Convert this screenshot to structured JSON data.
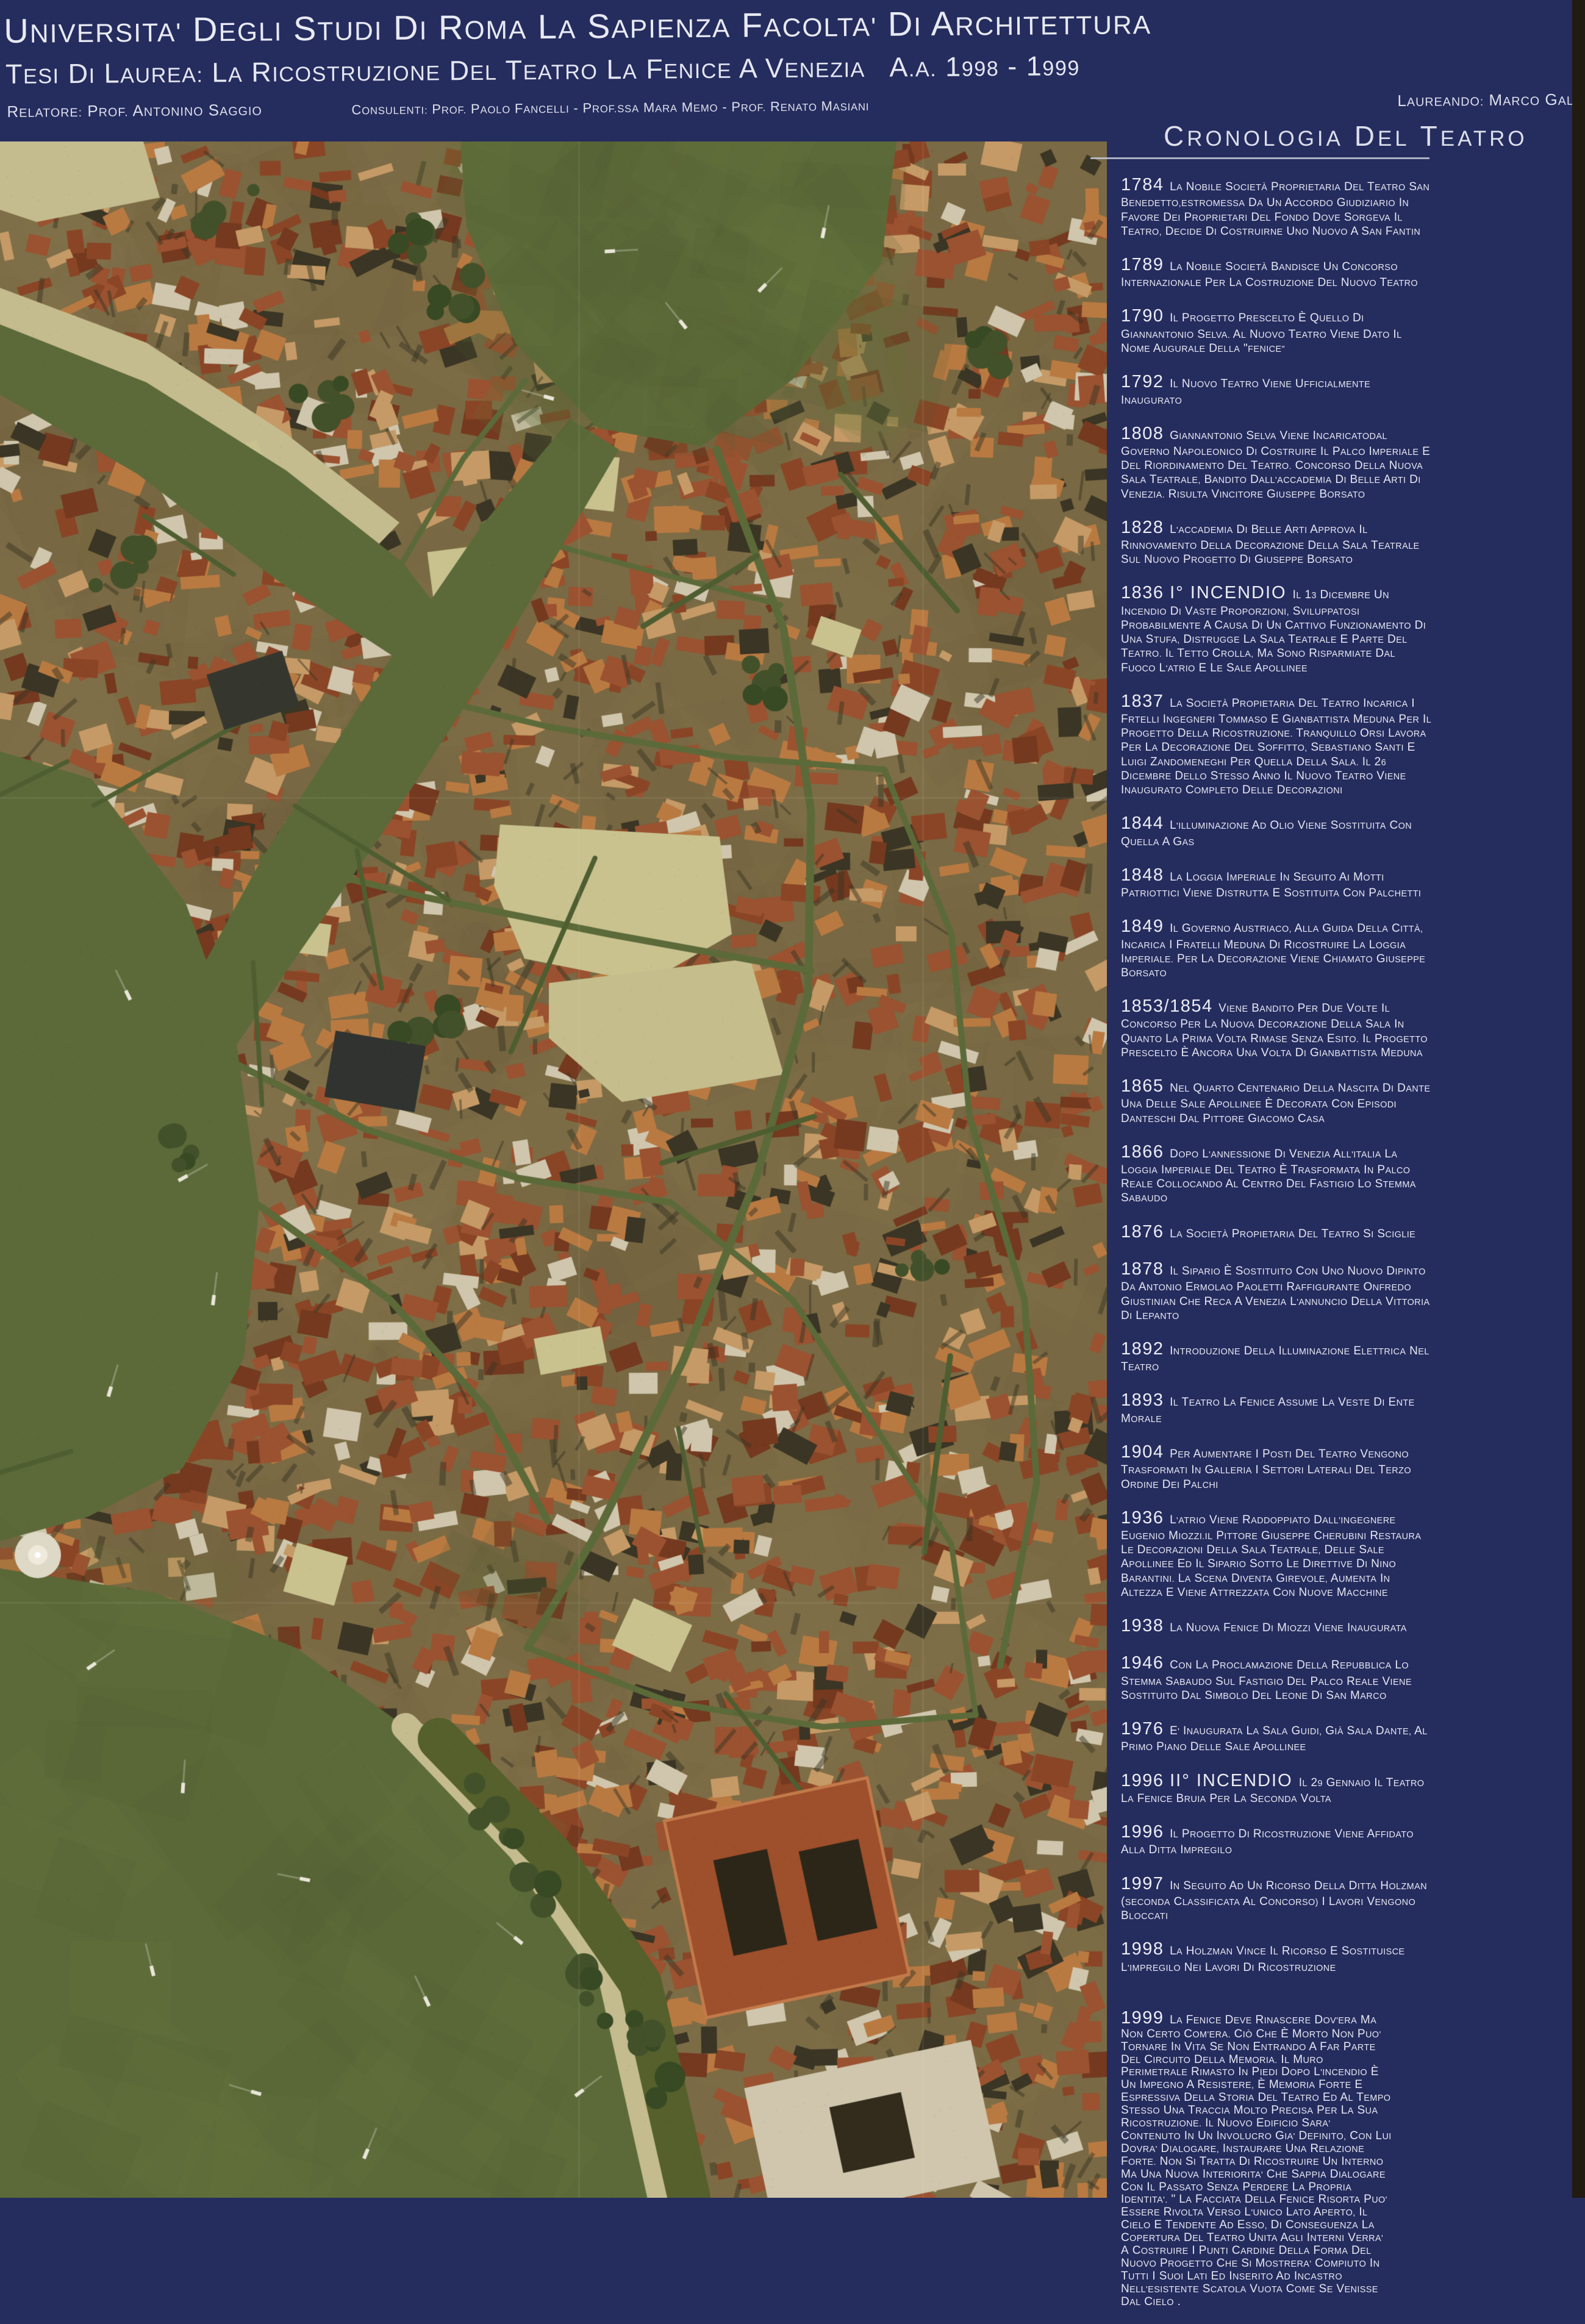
{
  "header": {
    "line1": "UNIVERSITA' DEGLI STUDI DI ROMA LA SAPIENZA FACOLTA' DI ARCHITETTURA",
    "line2": "TESI DI LAUREA: LA RICOSTRUZIONE DEL TEATRO LA FENICE A VENEZIA   A.A. 1998 - 1999",
    "relatore": "RELATORE: PROF. ANTONINO SAGGIO",
    "consulenti": "CONSULENTI: PROF. PAOLO FANCELLI - PROF.SSA MARA MEMO - PROF. RENATO MASIANI",
    "laureando": "LAUREANDO: MARCO GALOFARI"
  },
  "chronology": {
    "title": "CRONOLOGIA DEL TEATRO",
    "entries": [
      {
        "year": "1784",
        "label": "",
        "text": "LA NOBILE SOCIETÀ PROPRIETARIA DEL TEATRO SAN BENEDETTO,ESTROMESSA DA UN ACCORDO GIUDIZIARIO IN FAVORE DEI PROPRIETARI DEL FONDO DOVE SORGEVA IL TEATRO, DECIDE DI COSTRUIRNE UNO NUOVO A SAN FANTIN"
      },
      {
        "year": "1789",
        "label": "",
        "text": "LA NOBILE SOCIETÀ BANDISCE UN CONCORSO INTERNAZIONALE PER LA COSTRUZIONE DEL NUOVO TEATRO"
      },
      {
        "year": "1790",
        "label": "",
        "text": "IL PROGETTO PRESCELTO È QUELLO DI GIANNANTONIO SELVA. AL NUOVO TEATRO VIENE DATO IL NOME AUGURALE DELLA \"FENICE\""
      },
      {
        "year": "1792",
        "label": "",
        "text": "IL NUOVO TEATRO VIENE UFFICIALMENTE INAUGURATO"
      },
      {
        "year": "1808",
        "label": "",
        "text": "GIANNANTONIO SELVA VIENE INCARICATODAL GOVERNO NAPOLEONICO DI COSTRUIRE IL PALCO IMPERIALE E DEL RIORDINAMENTO DEL TEATRO. CONCORSO DELLA NUOVA SALA TEATRALE, BANDITO DALL'ACCADEMIA DI BELLE ARTI DI VENEZIA. RISULTA VINCITORE GIUSEPPE BORSATO"
      },
      {
        "year": "1828",
        "label": "",
        "text": "L'ACCADEMIA DI BELLE ARTI APPROVA IL RINNOVAMENTO DELLA DECORAZIONE DELLA SALA TEATRALE SUL NUOVO PROGETTO DI GIUSEPPE BORSATO"
      },
      {
        "year": "1836",
        "label": "I° INCENDIO",
        "text": "IL 13 DICEMBRE UN INCENDIO DI VASTE PROPORZIONI, SVILUPPATOSI PROBABILMENTE A CAUSA DI UN CATTIVO FUNZIONAMENTO DI UNA STUFA, DISTRUGGE LA SALA TEATRALE E PARTE DEL TEATRO. IL TETTO CROLLA, MA SONO RISPARMIATE DAL FUOCO L'ATRIO E LE SALE APOLLINEE"
      },
      {
        "year": "1837",
        "label": "",
        "text": "LA SOCIETÀ PROPIETARIA DEL TEATRO INCARICA I FRTELLI INGEGNERI TOMMASO E GIANBATTISTA MEDUNA PER IL PROGETTO DELLA RICOSTRUZIONE. TRANQUILLO ORSI LAVORA PER LA DECORAZIONE DEL SOFFITTO, SEBASTIANO SANTI E LUIGI ZANDOMENEGHI PER QUELLA DELLA SALA. IL 26 DICEMBRE DELLO STESSO ANNO IL NUOVO TEATRO VIENE INAUGURATO COMPLETO DELLE DECORAZIONI"
      },
      {
        "year": "1844",
        "label": "",
        "text": "L'ILLUMINAZIONE AD OLIO VIENE SOSTITUITA CON QUELLA A GAS"
      },
      {
        "year": "1848",
        "label": "",
        "text": "LA LOGGIA IMPERIALE IN SEGUITO AI MOTTI PATRIOTTICI VIENE DISTRUTTA E SOSTITUITA CON PALCHETTI"
      },
      {
        "year": "1849",
        "label": "",
        "text": "IL GOVERNO AUSTRIACO, ALLA GUIDA DELLA CITTÀ, INCARICA I FRATELLI MEDUNA DI RICOSTRUIRE LA LOGGIA IMPERIALE. PER LA DECORAZIONE VIENE CHIAMATO GIUSEPPE BORSATO"
      },
      {
        "year": "1853/1854",
        "label": "",
        "text": "VIENE BANDITO PER DUE VOLTE IL CONCORSO PER LA NUOVA DECORAZIONE DELLA SALA IN QUANTO LA PRIMA VOLTA RIMASE SENZA ESITO. IL PROGETTO PRESCELTO È ANCORA UNA VOLTA DI GIANBATTISTA MEDUNA"
      },
      {
        "year": "1865",
        "label": "",
        "text": "NEL QUARTO CENTENARIO DELLA NASCITA DI DANTE UNA DELLE SALE APOLLINEE È DECORATA CON EPISODI DANTESCHI DAL PITTORE GIACOMO CASA"
      },
      {
        "year": "1866",
        "label": "",
        "text": "DOPO L'ANNESSIONE DI VENEZIA ALL'ITALIA LA LOGGIA IMPERIALE DEL TEATRO È TRASFORMATA IN PALCO REALE COLLOCANDO AL CENTRO DEL FASTIGIO LO STEMMA SABAUDO"
      },
      {
        "year": "1876",
        "label": "",
        "text": "LA SOCIETÀ PROPIETARIA DEL TEATRO SI SCIGLIE"
      },
      {
        "year": "1878",
        "label": "",
        "text": "IL SIPARIO È SOSTITUITO CON UNO NUOVO DIPINTO DA ANTONIO ERMOLAO PAOLETTI RAFFIGURANTE ONFREDO GIUSTINIAN CHE RECA A VENEZIA L'ANNUNCIO DELLA VITTORIA DI LEPANTO"
      },
      {
        "year": "1892",
        "label": "",
        "text": "INTRODUZIONE DELLA ILLUMINAZIONE ELETTRICA NEL TEATRO"
      },
      {
        "year": "1893",
        "label": "",
        "text": "IL TEATRO LA FENICE ASSUME LA VESTE DI ENTE MORALE"
      },
      {
        "year": "1904",
        "label": "",
        "text": "PER AUMENTARE I POSTI DEL TEATRO VENGONO TRASFORMATI IN GALLERIA I SETTORI LATERALI DEL TERZO ORDINE DEI PALCHI"
      },
      {
        "year": "1936",
        "label": "",
        "text": "L'ATRIO VIENE RADDOPPIATO DALL'INGEGNERE EUGENIO MIOZZI.IL PITTORE GIUSEPPE CHERUBINI RESTAURA LE DECORAZIONI DELLA SALA TEATRALE, DELLE SALE APOLLINEE ED IL SIPARIO SOTTO LE DIRETTIVE DI NINO BARANTINI. LA SCENA DIVENTA GIREVOLE, AUMENTA IN ALTEZZA E VIENE ATTREZZATA CON NUOVE MACCHINE"
      },
      {
        "year": "1938",
        "label": "",
        "text": "LA NUOVA FENICE DI MIOZZI VIENE INAUGURATA"
      },
      {
        "year": "1946",
        "label": "",
        "text": "CON LA PROCLAMAZIONE DELLA REPUBBLICA LO STEMMA SABAUDO SUL FASTIGIO DEL PALCO REALE VIENE SOSTITUITO DAL SIMBOLO DEL LEONE DI SAN MARCO"
      },
      {
        "year": "1976",
        "label": "",
        "text": "E' INAUGURATA LA SALA GUIDI, GIÀ SALA DANTE, AL PRIMO PIANO DELLE SALE APOLLINEE"
      },
      {
        "year": "1996",
        "label": "II° INCENDIO",
        "text": "IL 29 GENNAIO IL TEATRO LA FENICE BRUIA PER LA SECONDA VOLTA"
      },
      {
        "year": "1996",
        "label": "",
        "text": "IL PROGETTO DI RICOSTRUZIONE VIENE AFFIDATO ALLA DITTA IMPREGILO"
      },
      {
        "year": "1997",
        "label": "",
        "text": "IN SEGUITO AD UN RICORSO DELLA DITTA HOLZMAN (SECONDA CLASSIFICATA AL CONCORSO) I LAVORI VENGONO BLOCCATI"
      },
      {
        "year": "1998",
        "label": "",
        "text": "LA HOLZMAN VINCE IL RICORSO E SOSTITUISCE L'IMPREGILO NEI LAVORI DI RICOSTRUZIONE"
      },
      {
        "year": "1999",
        "label": "",
        "text": "LA FENICE DEVE RINASCERE DOV'ERA MA NON CERTO COM'ERA. CIÒ CHE È MORTO NON PUO' TORNARE IN VITA SE NON ENTRANDO A FAR PARTE DEL CIRCUITO DELLA MEMORIA. IL MURO PERIMETRALE RIMASTO IN PIEDI DOPO L'INCENDIO È UN IMPEGNO A RESISTERE, È MEMORIA FORTE E ESPRESSIVA DELLA STORIA DEL TEATRO ED AL TEMPO STESSO UNA TRACCIA MOLTO PRECISA PER LA SUA RICOSTRUZIONE. IL NUOVO EDIFICIO SARA' CONTENUTO IN UN INVOLUCRO GIA' DEFINITO, CON LUI DOVRA' DIALOGARE, INSTAURARE UNA RELAZIONE FORTE. NON SI TRATTA DI RICOSTRUIRE UN INTERNO MA UNA NUOVA INTERIORITA' CHE SAPPIA DIALOGARE CON IL PASSATO SENZA PERDERE LA PROPRIA IDENTITA'. \" LA FACCIATA DELLA FENICE RISORTA PUO' ESSERE RIVOLTA VERSO L'UNICO LATO APERTO, IL CIELO E TENDENTE AD ESSO, DI CONSEGUENZA LA COPERTURA DEL TEATRO UNITA AGLI INTERNI VERRA' A COSTRUIRE I PUNTI CARDINE DELLA FORMA DEL NUOVO PROGETTO CHE SI MOSTRERA' COMPIUTO IN TUTTI I SUOI LATI ED INSERITO AD INCASTRO NELL'ESISTENTE SCATOLA VUOTA COME SE VENISSE DAL CIELO ."
      }
    ]
  },
  "map": {
    "description": "Aerial photomosaic of central Venice: Grand Canal bend, dense terracotta rooftops, campi, San Marco basin with boats",
    "palette": {
      "land": "#7a6a45",
      "water": "#5c6a3a",
      "water_deep": "#4f5e31",
      "roof": "#9b5230",
      "roof_dark": "#74391f",
      "roof_mid": "#8a4526",
      "roof_light": "#b97a42",
      "roof_pale": "#c59a66",
      "plaza": "#c9c28f",
      "quay": "#c4bc8e",
      "tree": "#42512a",
      "tree_dark": "#384a24",
      "boat": "#e9e6d8",
      "shadow": "#3a3524",
      "dark_roof": "#35372f",
      "pale_building": "#cfc6ad",
      "red_complex": "#9e4f2b"
    }
  }
}
